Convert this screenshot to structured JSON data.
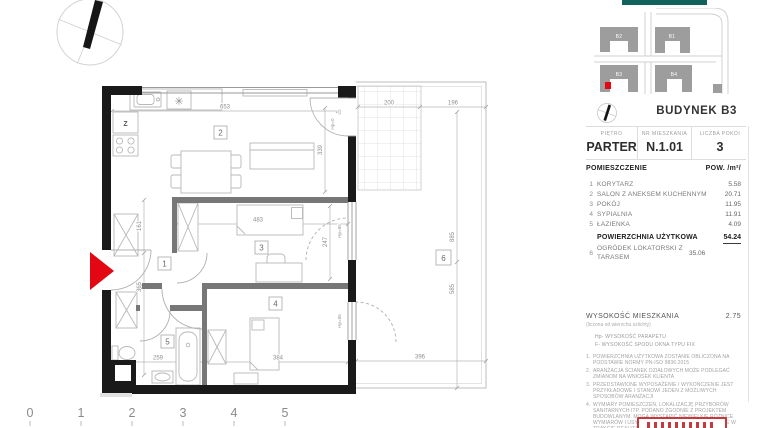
{
  "plan": {
    "room_numbers": [
      "1",
      "2",
      "3",
      "4",
      "5",
      "6"
    ],
    "labels": {
      "fridge": "Z",
      "burner": "✳"
    },
    "dims": {
      "d653": "653",
      "d200": "200",
      "d196": "196",
      "d339": "339",
      "d161": "161",
      "d365": "365",
      "d483": "483",
      "d247": "247",
      "d259": "259",
      "d384": "384",
      "d396": "396",
      "d885": "885",
      "d585": "585",
      "d22": "22",
      "hp0": "Hp=0",
      "hp85a": "Hp=85",
      "hp85b": "Hp=85"
    }
  },
  "scale_ticks": [
    "0",
    "1",
    "2",
    "3",
    "4",
    "5"
  ],
  "panel": {
    "accent_color": "#11615c",
    "map": {
      "buildings": [
        "B2",
        "B1",
        "B3",
        "B4"
      ],
      "marker_color": "#e30613"
    },
    "title": "BUDYNEK B3",
    "info": {
      "cols": [
        {
          "label": "PIĘTRO",
          "value": "PARTER"
        },
        {
          "label": "NR MIESZKANIA",
          "value": "N.1.01"
        },
        {
          "label": "LICZBA POKOI",
          "value": "3"
        }
      ]
    },
    "list": {
      "header_name": "POMIESZCZENIE",
      "header_area": "POW. /m²/",
      "items": [
        {
          "no": "1",
          "name": "KORYTARZ",
          "area": "5.58"
        },
        {
          "no": "2",
          "name": "SALON Z ANEKSEM KUCHENNYM",
          "area": "20.71"
        },
        {
          "no": "3",
          "name": "POKÓJ",
          "area": "11.95"
        },
        {
          "no": "4",
          "name": "SYPIALNIA",
          "area": "11.91"
        },
        {
          "no": "5",
          "name": "ŁAZIENKA",
          "area": "4.09"
        }
      ],
      "total": {
        "name": "POWIERZCHNIA UŻYTKOWA",
        "area": "54.24"
      },
      "garden": {
        "no": "6",
        "name": "OGRÓDEK LOKATORSKI Z TARASEM",
        "area": "35.06"
      }
    },
    "height": {
      "label": "WYSOKOŚĆ MIESZKANIA",
      "value": "2.75",
      "sub": "(liczona od wierzchu szlichty)",
      "legend": [
        "Hp- WYSOKOŚĆ PARAPETU",
        "F- WYSOKOŚĆ SPODU OKNA TYPU FIX"
      ]
    },
    "notes": [
      {
        "no": "1.",
        "text": "POWIERZCHNIA UŻYTKOWA ZOSTANIE OBLICZONA NA PODSTAWIE NORMY PN-ISO 9836:2015"
      },
      {
        "no": "2.",
        "text": "ARANŻACJA ŚCIANEK DZIAŁOWYCH MOŻE PODLEGAĆ ZMIANOM NA WNIOSEK KLIENTA"
      },
      {
        "no": "3.",
        "text": "PRZEDSTAWIONE WYPOSAŻENIE I WYKOŃCZENIE JEST PRZYKŁADOWE I STANOWI JEDEN Z MOŻLIWYCH SPOSOBÓW ARANŻACJI"
      },
      {
        "no": "4.",
        "text": "WYMIARY POMIESZCZEŃ, LOKALIZACJĘ PRZYBORÓW SANITARNYCH ITP. PODANO ZGODNIE Z PROJEKTEM BUDOWLANYM. MOGĄ WYSTĄPIĆ NIEWIELKIE RÓŻNICE WYMIARÓW I USYTUOWANIA ELEMENTÓW POWSTAŁE W TRAKCIE REALIZACJI PRAC BUDOWLANYCH"
      }
    ]
  }
}
